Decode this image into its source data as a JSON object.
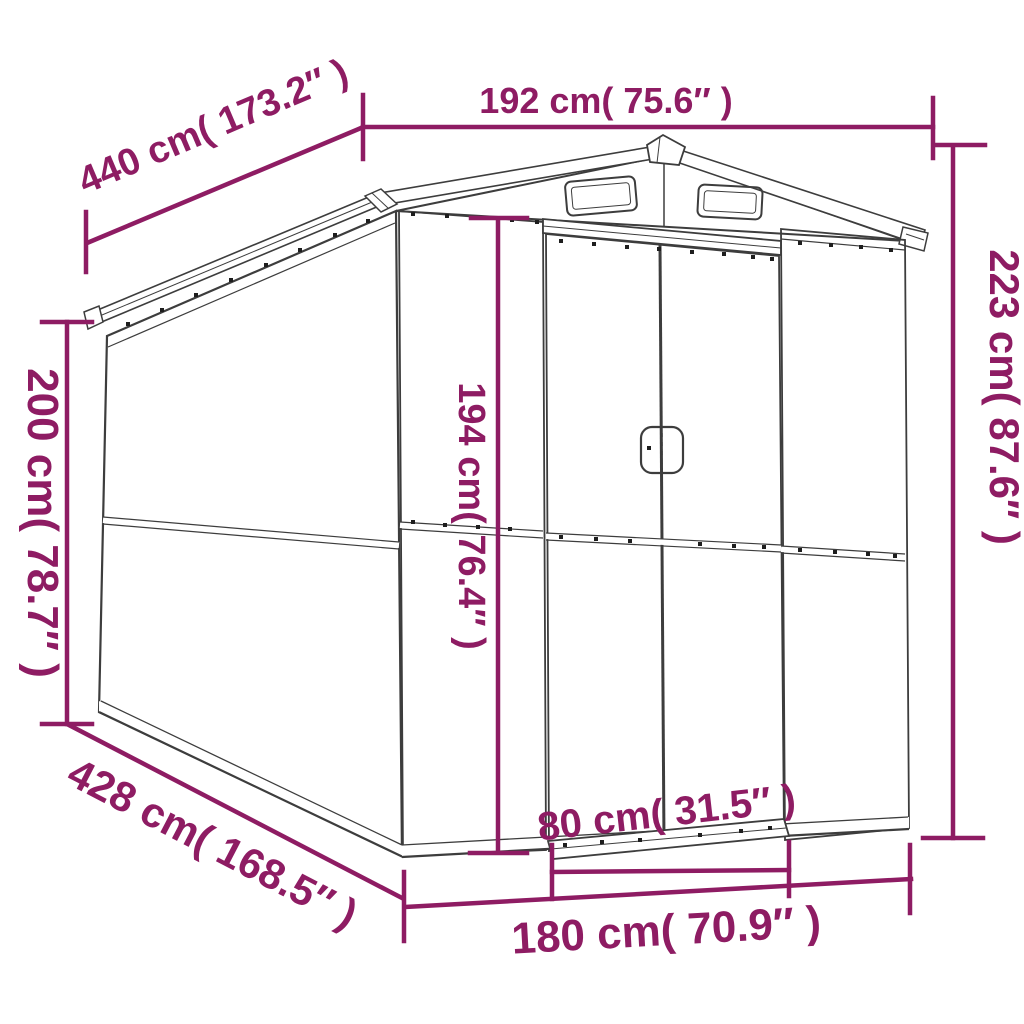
{
  "diagram": {
    "type": "product dimension line drawing",
    "subject": "metal garden shed with gable roof, two roof vents and double sliding doors",
    "colors": {
      "dimension_annotation": "#8E1C63",
      "line_art": "#3d3d3d",
      "background": "#ffffff"
    },
    "labels": {
      "roof_width_top": "192 cm( 75.6″ )",
      "roof_length": "440 cm( 173.2″ )",
      "overall_height": "223 cm( 87.6″ )",
      "wall_height": "200 cm( 78.7″ )",
      "door_height": "194 cm( 76.4″ )",
      "base_length": "428 cm( 168.5″ )",
      "door_width": "80 cm( 31.5″ )",
      "base_width": "180 cm( 70.9″ )"
    }
  }
}
